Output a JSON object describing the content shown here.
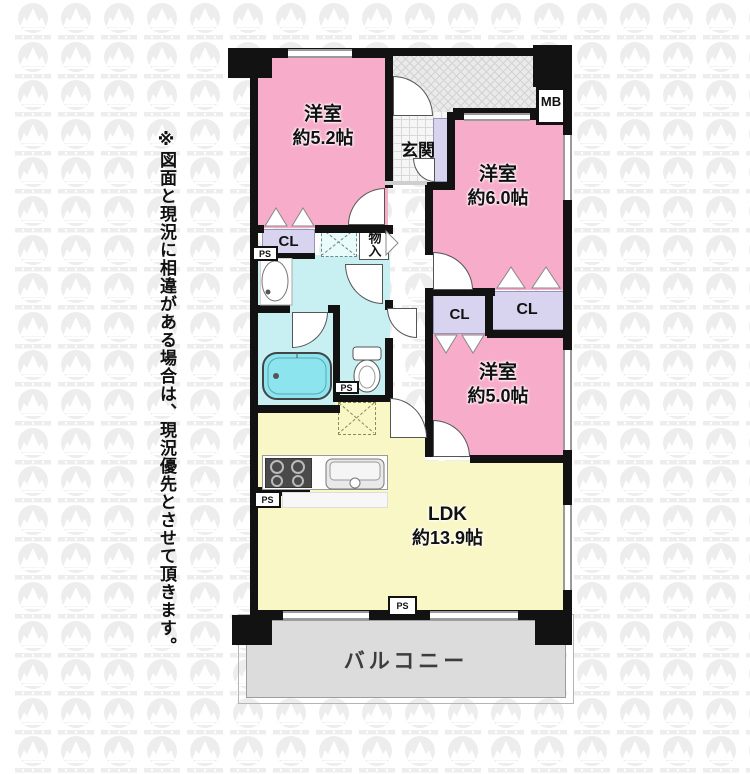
{
  "disclaimer": "※図面と現況に相違がある場合は、現況優先とさせて頂きます。",
  "plan": {
    "rooms": [
      {
        "id": "bedroom-1",
        "name": "洋室",
        "size": "約5.2帖"
      },
      {
        "id": "bedroom-2",
        "name": "洋室",
        "size": "約6.0帖"
      },
      {
        "id": "bedroom-3",
        "name": "洋室",
        "size": "約5.0帖"
      },
      {
        "id": "ldk",
        "name": "LDK",
        "size": "約13.9帖"
      }
    ],
    "labels": {
      "entrance": "玄関",
      "balcony": "バルコニー",
      "closet": "CL",
      "storage": "物入",
      "meter_box": "MB",
      "pipe_space": "PS"
    },
    "colors": {
      "bedroom": "#f7acc9",
      "ldk": "#faf7c6",
      "wet_area": "#c8f0f2",
      "bathtub": "#8be4ee",
      "closet": "#d8d3ef",
      "balcony": "#dcdcdc",
      "wall": "#121212"
    }
  }
}
